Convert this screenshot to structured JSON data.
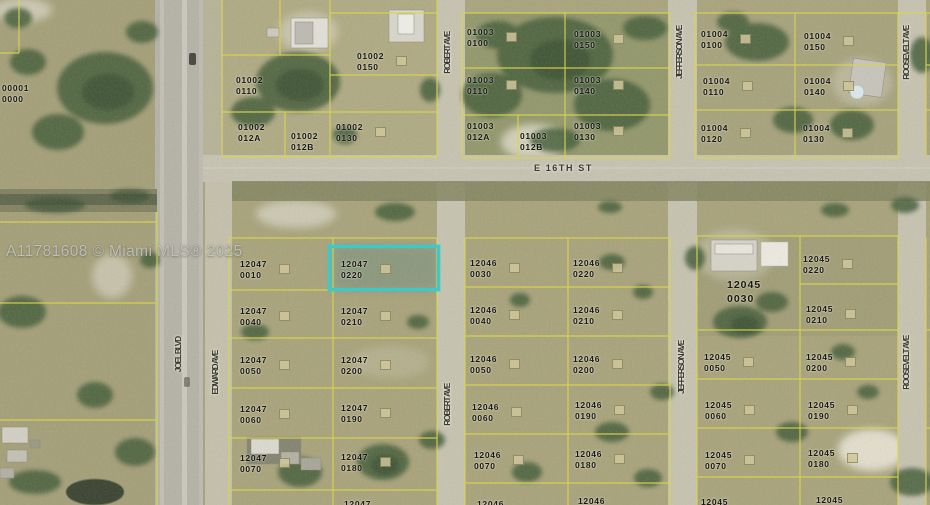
{
  "map": {
    "watermark": "A11781608 © Miami MLS® 2025",
    "highlight": {
      "parcel": "12047 0220",
      "color": "#3cc9c9",
      "box": {
        "x": 328,
        "y": 245,
        "w": 112,
        "h": 46
      }
    },
    "line_color": "#d9d450",
    "streets": [
      {
        "name": "E 16TH ST",
        "orientation": "horizontal",
        "x": 534,
        "y": 163
      },
      {
        "name": "JOEL BLVD",
        "orientation": "vertical",
        "x": 173,
        "y": 337
      },
      {
        "name": "EDWARD AVE",
        "orientation": "vertical",
        "x": 210,
        "y": 351
      },
      {
        "name": "ROBERT AVE",
        "orientation": "vertical",
        "x": 442,
        "y": 32
      },
      {
        "name": "ROBERT AVE",
        "orientation": "vertical",
        "x": 442,
        "y": 384
      },
      {
        "name": "JEFFERSON AVE",
        "ororientation": "vertical",
        "orientation": "vertical",
        "x": 674,
        "y": 26
      },
      {
        "name": "JEFFERSON AVE",
        "orientation": "vertical",
        "x": 676,
        "y": 341
      },
      {
        "name": "ROOSEVELT AVE",
        "orientation": "vertical",
        "x": 901,
        "y": 26
      },
      {
        "name": "ROOSEVELT AVE",
        "orientation": "vertical",
        "x": 901,
        "y": 336
      }
    ],
    "parcels": [
      {
        "block": "00001",
        "lot": "0000",
        "x": 2,
        "y": 83
      },
      {
        "block": "01002",
        "lot": "0150",
        "x": 357,
        "y": 51,
        "marker": true
      },
      {
        "block": "01002",
        "lot": "0110",
        "x": 236,
        "y": 75
      },
      {
        "block": "01002",
        "lot": "012A",
        "x": 238,
        "y": 122
      },
      {
        "block": "01002",
        "lot": "012B",
        "x": 291,
        "y": 131
      },
      {
        "block": "01002",
        "lot": "0130",
        "x": 336,
        "y": 122,
        "marker": true
      },
      {
        "block": "01003",
        "lot": "0100",
        "x": 467,
        "y": 27,
        "marker": true
      },
      {
        "block": "01003",
        "lot": "0150",
        "x": 574,
        "y": 29,
        "marker": true
      },
      {
        "block": "01003",
        "lot": "0110",
        "x": 467,
        "y": 75,
        "marker": true
      },
      {
        "block": "01003",
        "lot": "0140",
        "x": 574,
        "y": 75,
        "marker": true
      },
      {
        "block": "01003",
        "lot": "012A",
        "x": 467,
        "y": 121
      },
      {
        "block": "01003",
        "lot": "012B",
        "x": 520,
        "y": 131
      },
      {
        "block": "01003",
        "lot": "0130",
        "x": 574,
        "y": 121,
        "marker": true
      },
      {
        "block": "01004",
        "lot": "0100",
        "x": 701,
        "y": 29,
        "marker": true
      },
      {
        "block": "01004",
        "lot": "0150",
        "x": 804,
        "y": 31,
        "marker": true
      },
      {
        "block": "01004",
        "lot": "0110",
        "x": 703,
        "y": 76,
        "marker": true
      },
      {
        "block": "01004",
        "lot": "0140",
        "x": 804,
        "y": 76,
        "marker": true
      },
      {
        "block": "01004",
        "lot": "0120",
        "x": 701,
        "y": 123,
        "marker": true
      },
      {
        "block": "01004",
        "lot": "0130",
        "x": 803,
        "y": 123,
        "marker": true
      },
      {
        "block": "12047",
        "lot": "0010",
        "x": 240,
        "y": 259,
        "marker": true
      },
      {
        "block": "12047",
        "lot": "0220",
        "x": 341,
        "y": 259,
        "marker": true,
        "highlighted": true
      },
      {
        "block": "12047",
        "lot": "0040",
        "x": 240,
        "y": 306,
        "marker": true
      },
      {
        "block": "12047",
        "lot": "0210",
        "x": 341,
        "y": 306,
        "marker": true
      },
      {
        "block": "12047",
        "lot": "0050",
        "x": 240,
        "y": 355,
        "marker": true
      },
      {
        "block": "12047",
        "lot": "0200",
        "x": 341,
        "y": 355,
        "marker": true
      },
      {
        "block": "12047",
        "lot": "0060",
        "x": 240,
        "y": 404,
        "marker": true
      },
      {
        "block": "12047",
        "lot": "0190",
        "x": 341,
        "y": 403,
        "marker": true
      },
      {
        "block": "12047",
        "lot": "0070",
        "x": 240,
        "y": 453,
        "marker": true
      },
      {
        "block": "12047",
        "lot": "0180",
        "x": 341,
        "y": 452,
        "marker": true
      },
      {
        "block": "12047",
        "lot": "",
        "x": 344,
        "y": 499,
        "partial": true
      },
      {
        "block": "12046",
        "lot": "0030",
        "x": 470,
        "y": 258,
        "marker": true
      },
      {
        "block": "12046",
        "lot": "0220",
        "x": 573,
        "y": 258,
        "marker": true
      },
      {
        "block": "12046",
        "lot": "0040",
        "x": 470,
        "y": 305,
        "marker": true
      },
      {
        "block": "12046",
        "lot": "0210",
        "x": 573,
        "y": 305,
        "marker": true
      },
      {
        "block": "12046",
        "lot": "0050",
        "x": 470,
        "y": 354,
        "marker": true
      },
      {
        "block": "12046",
        "lot": "0200",
        "x": 573,
        "y": 354,
        "marker": true
      },
      {
        "block": "12046",
        "lot": "0060",
        "x": 472,
        "y": 402,
        "marker": true
      },
      {
        "block": "12046",
        "lot": "0190",
        "x": 575,
        "y": 400,
        "marker": true
      },
      {
        "block": "12046",
        "lot": "0070",
        "x": 474,
        "y": 450,
        "marker": true
      },
      {
        "block": "12046",
        "lot": "0180",
        "x": 575,
        "y": 449,
        "marker": true
      },
      {
        "block": "12046",
        "lot": "",
        "x": 477,
        "y": 499,
        "partial": true
      },
      {
        "block": "12046",
        "lot": "",
        "x": 578,
        "y": 496,
        "partial": true
      },
      {
        "block": "12045",
        "lot": "0220",
        "x": 803,
        "y": 254,
        "marker": true
      },
      {
        "block": "12045",
        "lot": "0030",
        "x": 727,
        "y": 279,
        "size": "lg"
      },
      {
        "block": "12045",
        "lot": "0210",
        "x": 806,
        "y": 304,
        "marker": true
      },
      {
        "block": "12045",
        "lot": "0050",
        "x": 704,
        "y": 352,
        "marker": true
      },
      {
        "block": "12045",
        "lot": "0200",
        "x": 806,
        "y": 352,
        "marker": true
      },
      {
        "block": "12045",
        "lot": "0060",
        "x": 705,
        "y": 400,
        "marker": true
      },
      {
        "block": "12045",
        "lot": "0190",
        "x": 808,
        "y": 400,
        "marker": true
      },
      {
        "block": "12045",
        "lot": "0070",
        "x": 705,
        "y": 450,
        "marker": true
      },
      {
        "block": "12045",
        "lot": "0180",
        "x": 808,
        "y": 448,
        "marker": true
      },
      {
        "block": "12045",
        "lot": "",
        "x": 701,
        "y": 497,
        "partial": true
      },
      {
        "block": "12045",
        "lot": "",
        "x": 816,
        "y": 495,
        "partial": true
      }
    ]
  }
}
